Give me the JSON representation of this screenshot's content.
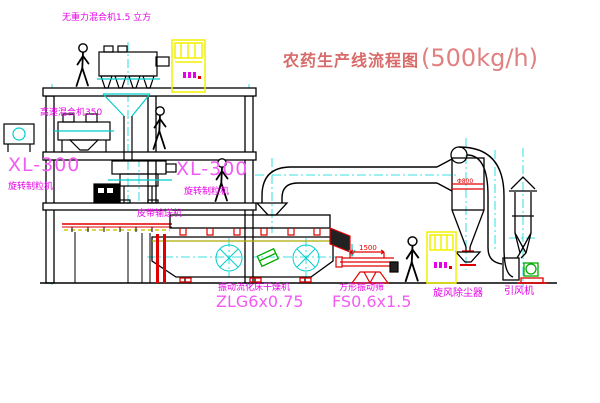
{
  "title": {
    "name": "农药生产线流程图",
    "capacity": "(500kg/h)"
  },
  "labels": {
    "top_mixer": "无重力混合机1.5 立方",
    "high_speed_mixer": "高速混合机350",
    "granulator_left_model": "XL-300",
    "granulator_left_name": "旋转制粒机",
    "granulator_right_model": "XL-300",
    "granulator_right_name": "旋转制粒机",
    "belt_conveyor": "皮带输送机",
    "dryer_name": "振动流化床干燥机",
    "dryer_model": "ZLG6x0.75",
    "sieve_name": "方形振动筛",
    "sieve_model": "FS0.6x1.5",
    "cyclone": "旋风除尘器",
    "fan": "引风机",
    "sieve_dimension": "1500",
    "cyclone_size": "Φ800"
  },
  "colors": {
    "label_magenta": "#E600E6",
    "model_magenta": "#F25CF2",
    "title_red": "#D96A6A",
    "accent_red": "#E00000",
    "centerline_cyan": "#00D8D8",
    "cabinet_yellow": "#F2F200",
    "machine_green": "#00AA00",
    "line_black": "#000000"
  }
}
